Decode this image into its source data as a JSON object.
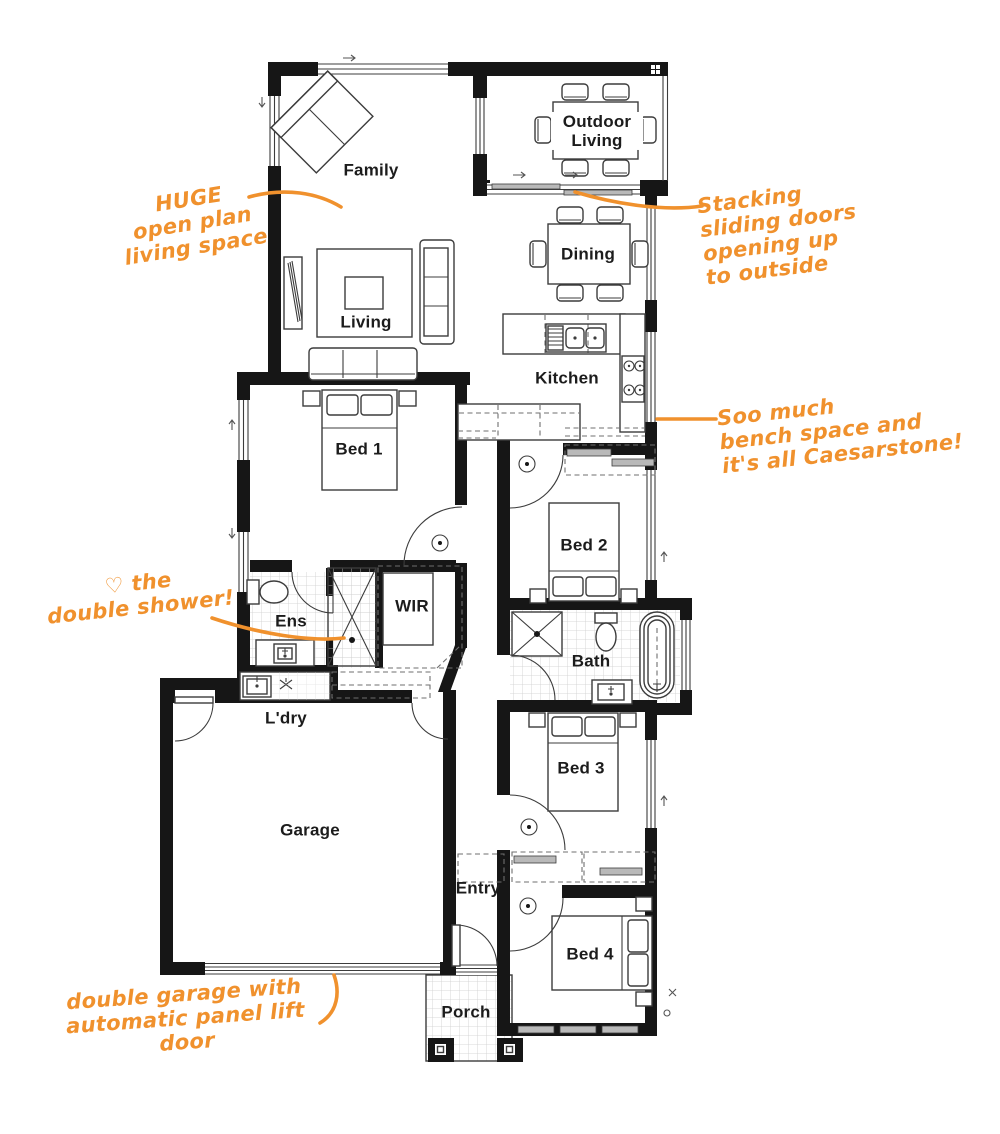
{
  "figure": {
    "type": "floor-plan"
  },
  "colors": {
    "accent": "#F0912D",
    "wall": "#161616",
    "line": "#3C3C3C"
  },
  "rooms": {
    "family": "Family",
    "outdoor_living": "Outdoor Living",
    "dining": "Dining",
    "kitchen": "Kitchen",
    "living": "Living",
    "bed1": "Bed 1",
    "bed2": "Bed 2",
    "bed3": "Bed 3",
    "bed4": "Bed 4",
    "ens": "Ens",
    "wir": "WIR",
    "bath": "Bath",
    "ldry": "L'dry",
    "garage": "Garage",
    "entry": "Entry",
    "porch": "Porch"
  },
  "annotations": {
    "open_plan": "HUGE\nopen plan\nliving space",
    "stacking_doors": "Stacking\nsliding doors\nopening up\nto outside",
    "bench_space": "Soo much\nbench space and\nit's all Caesarstone!",
    "double_shower": "♡ the\ndouble shower!",
    "garage_door": "double garage with\nautomatic panel lift door"
  }
}
